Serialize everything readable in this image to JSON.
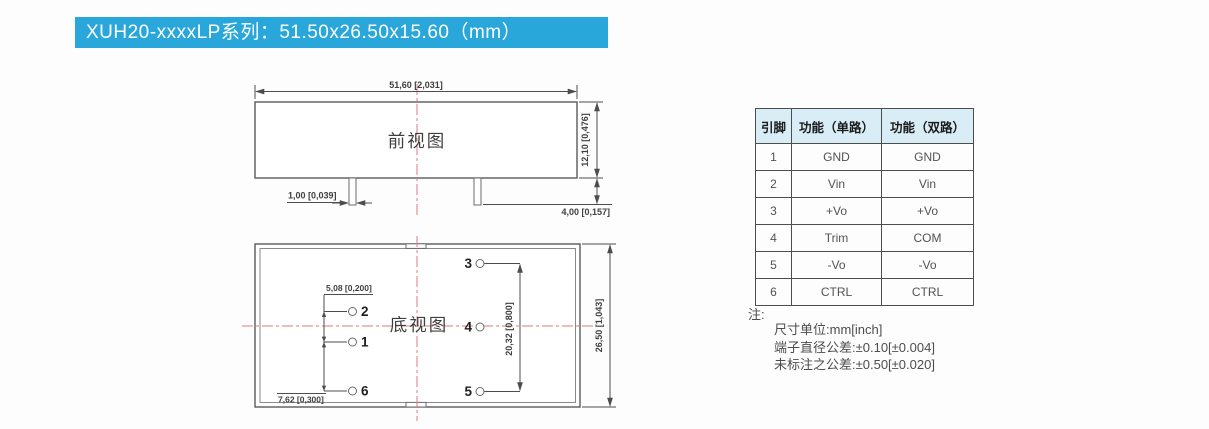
{
  "banner": {
    "title": "XUH20-xxxxLP系列：51.50x26.50x15.60（mm）",
    "bg_color": "#29a7db"
  },
  "front_view": {
    "label": "前视图",
    "dim_width": "51,60 [2,031]",
    "dim_height": "12,10 [0,476]",
    "dim_pin_width": "1,00 [0,039]",
    "dim_pin_length": "4,00 [0,157]"
  },
  "bottom_view": {
    "label": "底视图",
    "dim_pitch_small": "5,08 [0,200]",
    "dim_pitch_large": "7,62 [0,300]",
    "dim_pin_span": "20,32 [0,800]",
    "dim_height": "26,50 [1,043]",
    "pins_left": [
      "2",
      "1",
      "6"
    ],
    "pins_right": [
      "3",
      "4",
      "5"
    ]
  },
  "pin_table": {
    "headers": [
      "引脚",
      "功能（单路）",
      "功能（双路）"
    ],
    "rows": [
      [
        "1",
        "GND",
        "GND"
      ],
      [
        "2",
        "Vin",
        "Vin"
      ],
      [
        "3",
        "+Vo",
        "+Vo"
      ],
      [
        "4",
        "Trim",
        "COM"
      ],
      [
        "5",
        "-Vo",
        "-Vo"
      ],
      [
        "6",
        "CTRL",
        "CTRL"
      ]
    ]
  },
  "notes": {
    "label": "注:",
    "lines": [
      "尺寸单位:mm[inch]",
      "端子直径公差:±0.10[±0.004]",
      "未标注之公差:±0.50[±0.020]"
    ]
  },
  "colors": {
    "accent_blue": "#29a7db",
    "table_header_bg": "#d9edf7",
    "centerline_red": "#e07b7b",
    "line_gray": "#4d4d4d"
  }
}
